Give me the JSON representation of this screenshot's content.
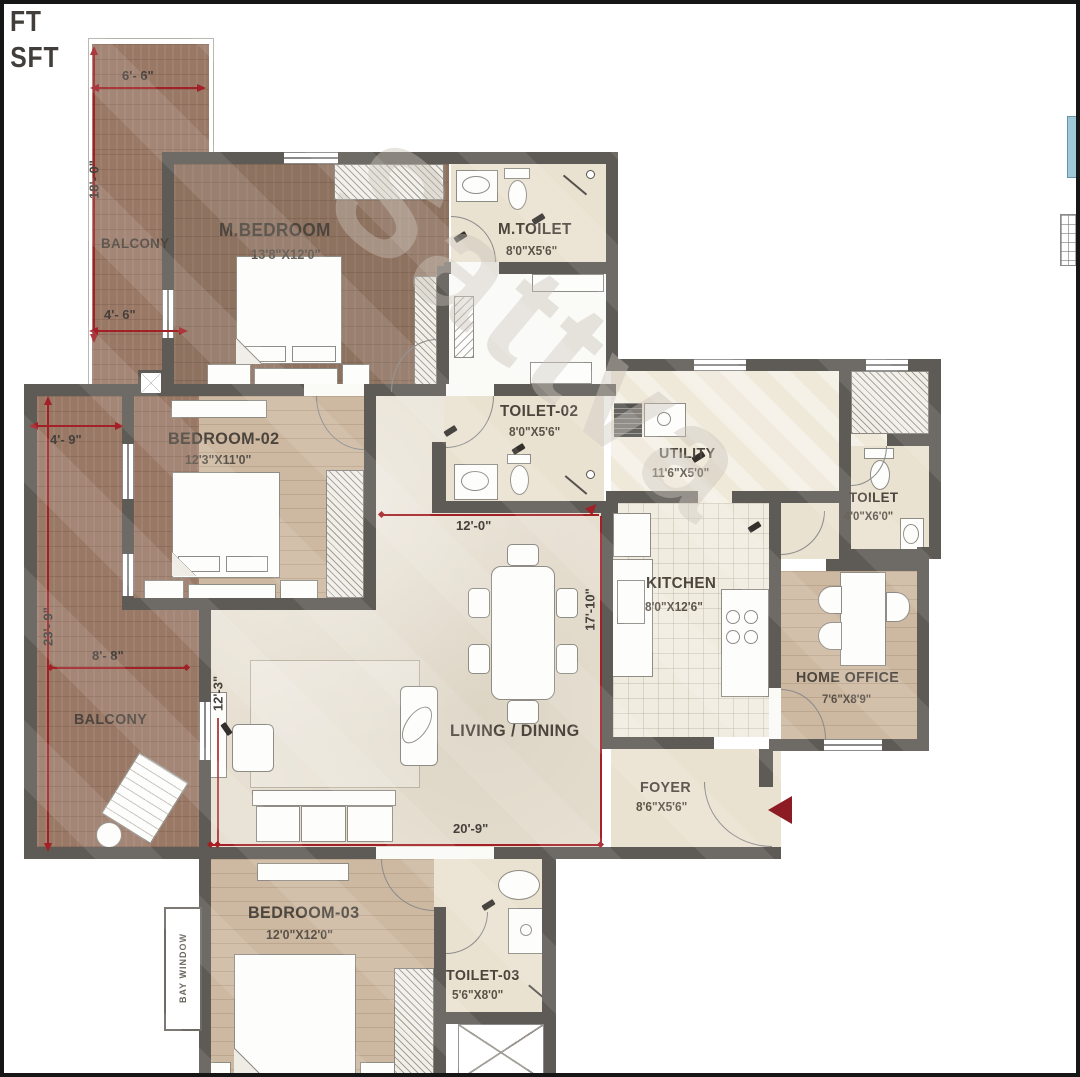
{
  "corner": {
    "line1": "FT",
    "line2": "8 SFT"
  },
  "watermark": "Sattva",
  "rooms": {
    "balcony_top": {
      "name": "BALCONY"
    },
    "m_bedroom": {
      "name": "M.BEDROOM",
      "size": "13'8\"X12'0\""
    },
    "m_toilet": {
      "name": "M.TOILET",
      "size": "8'0\"X5'6\""
    },
    "bedroom_02": {
      "name": "BEDROOM-02",
      "size": "12'3\"X11'0\""
    },
    "toilet_02": {
      "name": "TOILET-02",
      "size": "8'0\"X5'6\""
    },
    "utility": {
      "name": "UTILITY",
      "size": "11'6\"X5'0\""
    },
    "toilet": {
      "name": "TOILET",
      "size": "4'0\"X6'0\""
    },
    "kitchen": {
      "name": "KITCHEN",
      "size": "8'0\"X12'6\""
    },
    "home_office": {
      "name": "HOME OFFICE",
      "size": "7'6\"X8'9\""
    },
    "balcony_left": {
      "name": "BALCONY"
    },
    "living_dining": {
      "name": "LIVING / DINING"
    },
    "foyer": {
      "name": "FOYER",
      "size": "8'6\"X5'6\""
    },
    "bedroom_03": {
      "name": "BEDROOM-03",
      "size": "12'0\"X12'0\""
    },
    "toilet_03": {
      "name": "TOILET-03",
      "size": "5'6\"X8'0\""
    },
    "bay_window": {
      "name": "BAY WINDOW"
    }
  },
  "dims": {
    "d6_6": "6'- 6\"",
    "d18_0": "18'- 0\"",
    "d4_6": "4'- 6\"",
    "d4_9": "4'- 9\"",
    "d23_9": "23'- 9\"",
    "d8_8": "8'- 8\"",
    "d12_3": "12'-3\"",
    "d12_0": "12'-0\"",
    "d17_10": "17'-10\"",
    "d20_9": "20'-9\""
  },
  "colors": {
    "wall": "#5e5a55",
    "dimension_red": "#a32026",
    "entry_arrow": "#8c1b24",
    "wood_dark": "#9a7866",
    "wood_light": "#cdb9a2",
    "beige": "#eae2d0",
    "marble": "#e7e0d2",
    "keyplan_blue": "#9fc8d8"
  }
}
